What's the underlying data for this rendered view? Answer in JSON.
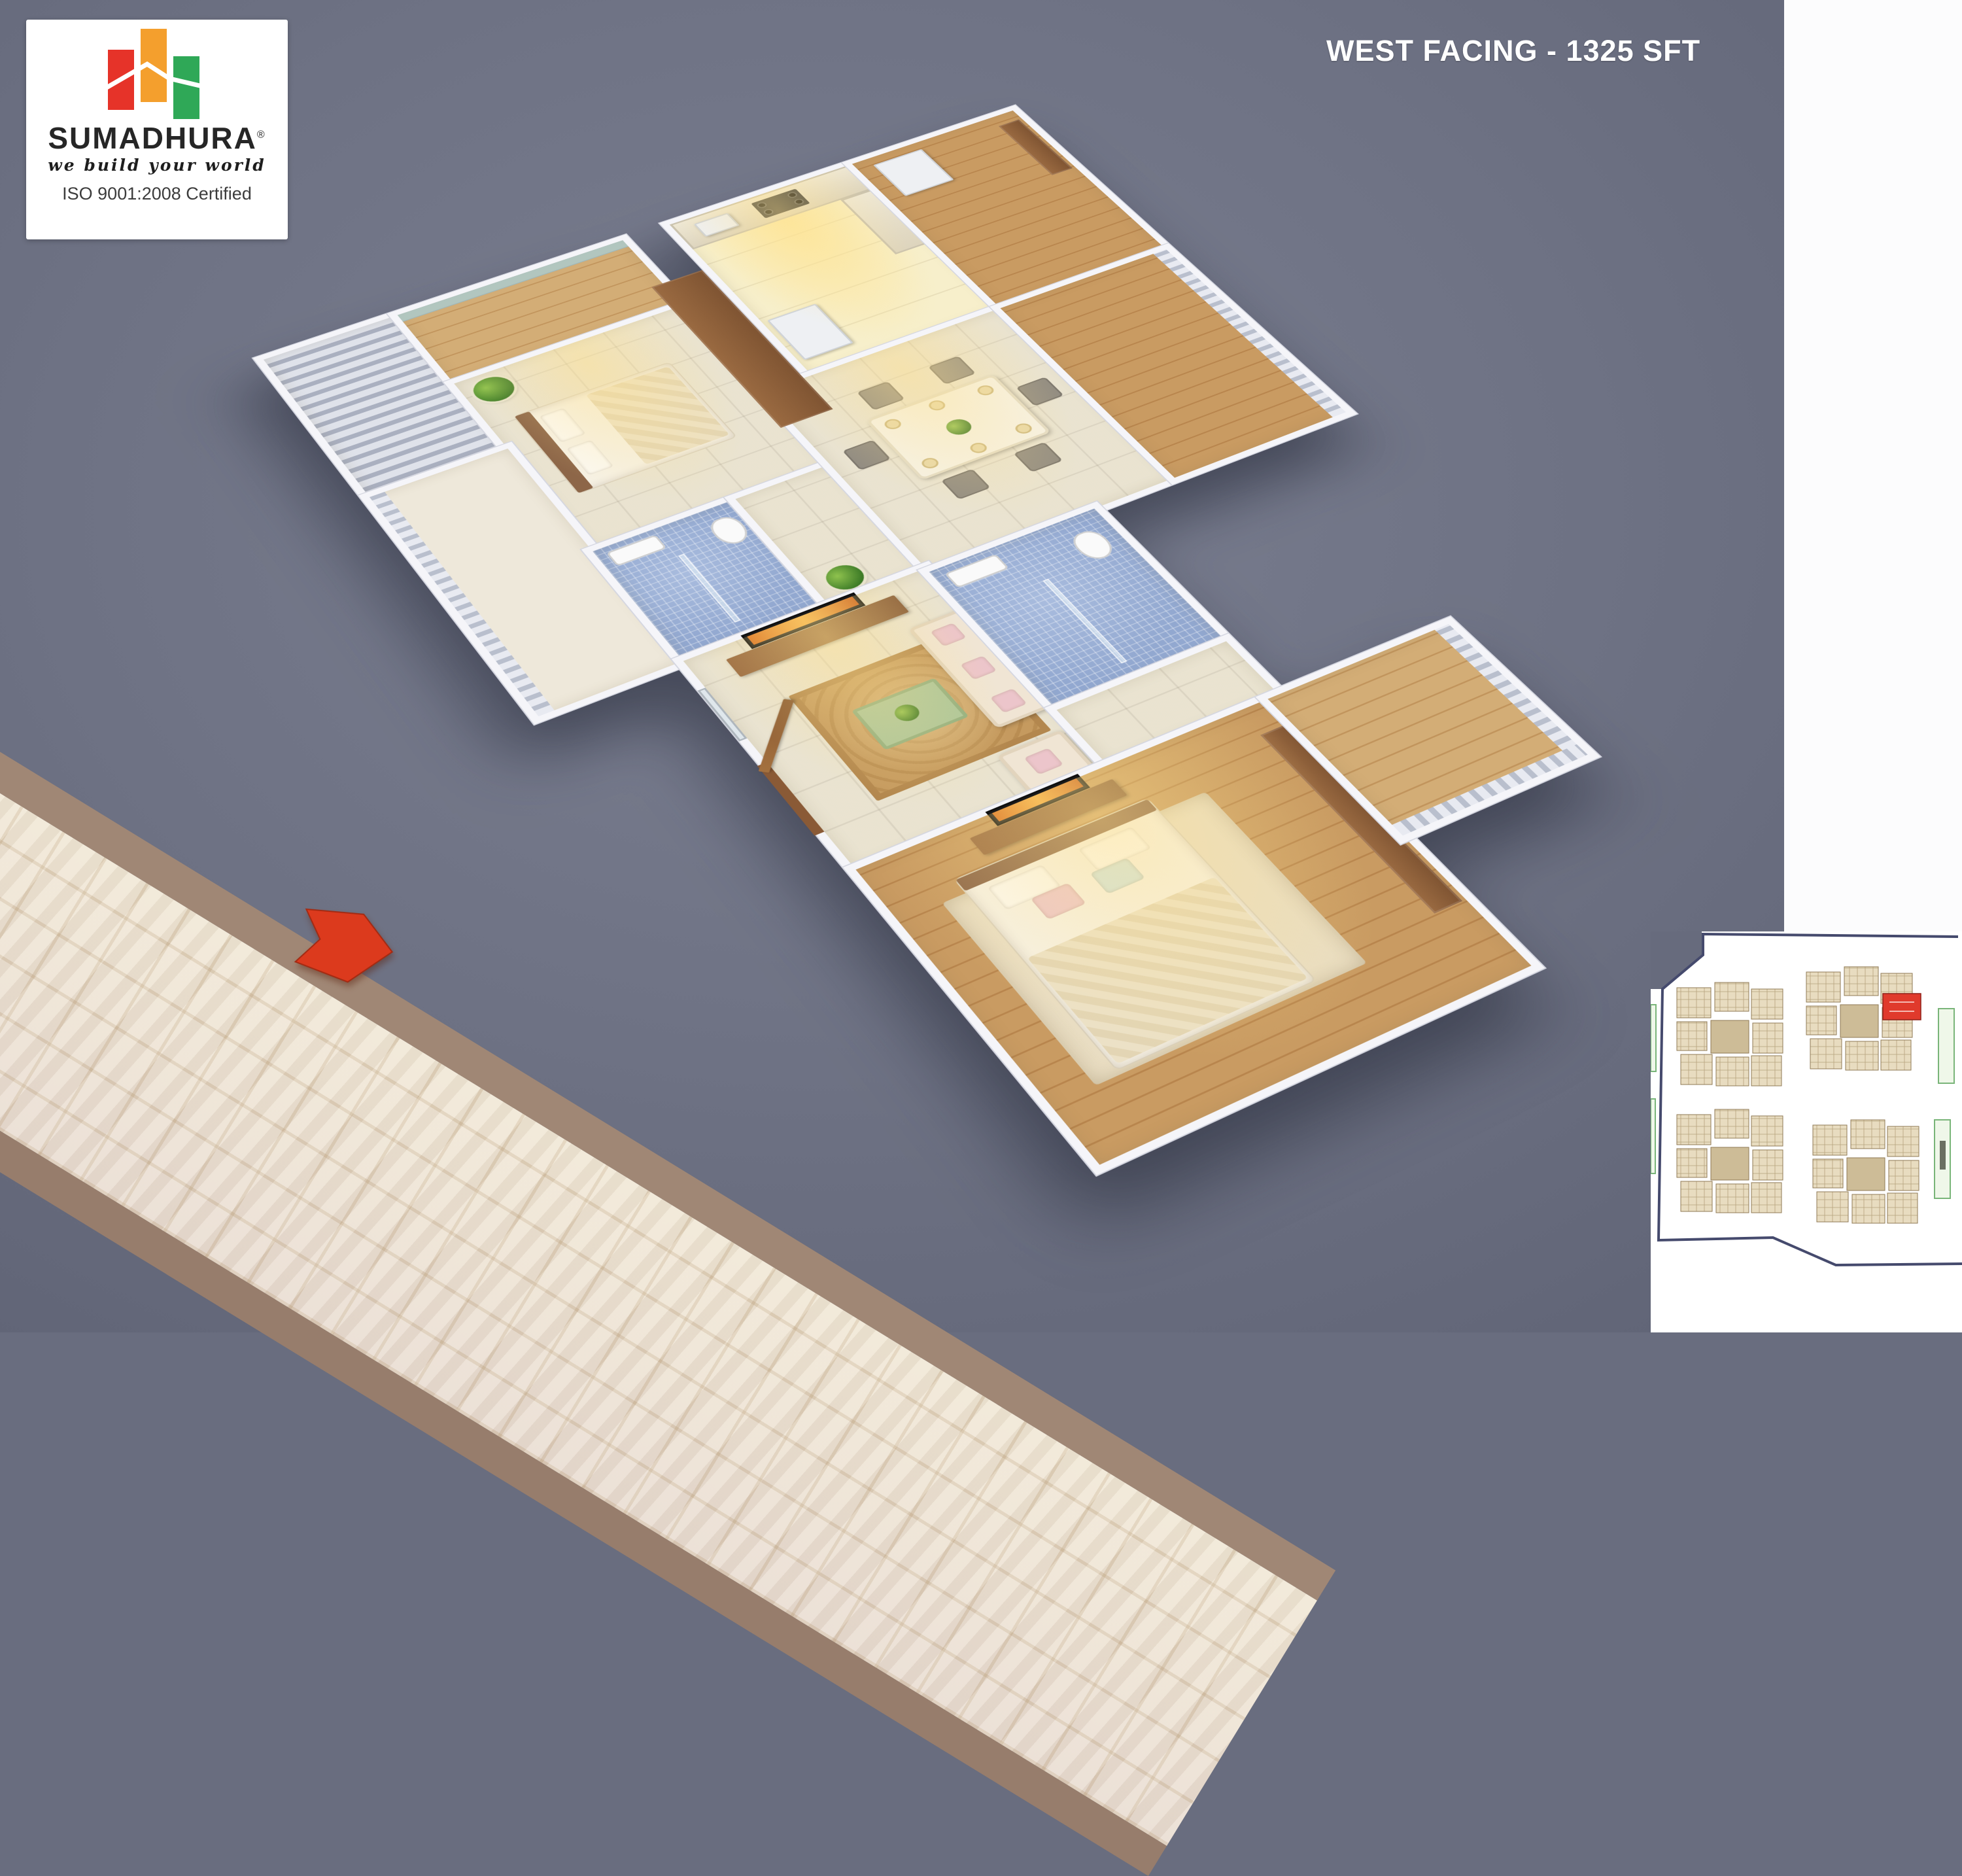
{
  "title": {
    "text": "WEST FACING - 1325 SFT"
  },
  "logo": {
    "brand": "SUMADHURA",
    "registered": "®",
    "tagline": "we build your world",
    "certification": "ISO 9001:2008 Certified",
    "bar_colors": {
      "red": "#e63329",
      "orange": "#f49f2d",
      "green": "#2fa857"
    }
  },
  "palette": {
    "background_gray": "#6e7284",
    "side_band_white": "#fcfcfd",
    "wall_white": "#f5f5f9",
    "floor_cream": "#f2ebd8",
    "kitchen_warm": "#f7efcb",
    "bath_tile_blue": "#92a8d0",
    "wood_brown": "#b8854d",
    "rug_tan": "#c59a5f",
    "road_tile": "#f1e8d6",
    "road_border": "#a08775",
    "arrow_red": "#dc3a1d"
  },
  "key_plan": {
    "boundary_color": "#454a6d",
    "cluster_fill": "#e8dcc0",
    "cluster_stroke": "#8f7a55",
    "highlight_color": "#e03a2c",
    "amenity_color": "#79b579",
    "clusters_count": 4
  }
}
